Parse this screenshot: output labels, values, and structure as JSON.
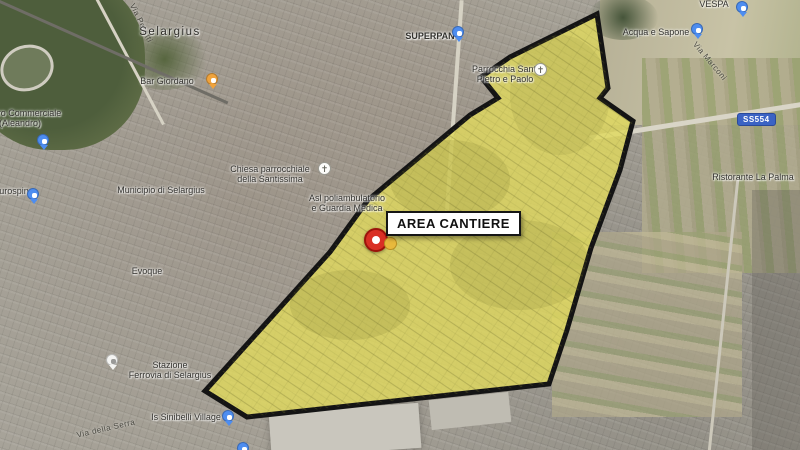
{
  "map": {
    "city_label": "Selargius",
    "area_box": {
      "label": "AREA CANTIERE"
    },
    "road_shield": {
      "label": "SS554"
    },
    "pois": {
      "superpan": "SUPERPAN",
      "acqua_e_sapone": "Acqua e Sapone",
      "vespa": "VESPA",
      "ristorante": "Ristorante La Palma",
      "centro_commerciale_l1": "Centro Commerciale",
      "centro_commerciale_l2": "(Aleandro)",
      "eurospin": "Eurospin",
      "municipio": "Municipio di Selargius",
      "chiesa_l1": "Chiesa parrocchiale",
      "chiesa_l2": "della Santissima",
      "asl_l1": "Asl poliambulatorio",
      "asl_l2": "e Guardia Medica",
      "parrocchia_l1": "Parrocchia Santi",
      "parrocchia_l2": "Pietro e Paolo",
      "bar_giordano": "Bar Giordano",
      "evoque": "Evoque",
      "stazione_l1": "Stazione",
      "stazione_l2": "Ferrovia di Selargius",
      "village": "Is Sinibelli Village"
    },
    "roads": {
      "via_peretti": "Via Peretti",
      "via_marconi": "Via Marconi",
      "via_della_serra": "Via della Serra"
    },
    "colors": {
      "polygon_fill": "#e0d95e",
      "polygon_stroke": "#141414",
      "marker_red": "#d93025",
      "marker_yellow": "#e8b93c",
      "poi_blue": "#4d8df0",
      "poi_orange": "#f0a33c",
      "shield_blue": "#3b63c4"
    }
  }
}
